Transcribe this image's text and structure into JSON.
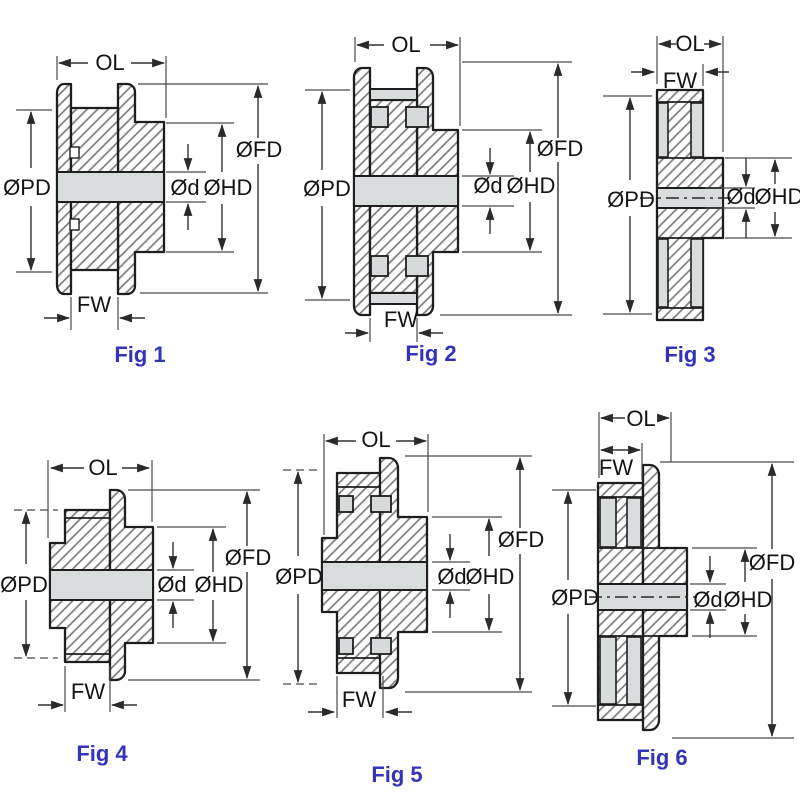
{
  "colors": {
    "caption_blue": "#3434bb",
    "outline": "#1e1e1e",
    "hatch_gray": "#7d7d7d",
    "light_fill": "#d9dcdc",
    "dimension_line": "#333333",
    "label_text": "#141414",
    "background": "#ffffff"
  },
  "figures": [
    {
      "caption": "Fig 1",
      "labels": {
        "ol": "OL",
        "fw": "FW",
        "pd": "ØPD",
        "fd": "ØFD",
        "hd": "ØHD",
        "d": "Ød"
      }
    },
    {
      "caption": "Fig 2",
      "labels": {
        "ol": "OL",
        "fw": "FW",
        "pd": "ØPD",
        "fd": "ØFD",
        "hd": "ØHD",
        "d": "Ød"
      }
    },
    {
      "caption": "Fig 3",
      "labels": {
        "ol": "OL",
        "fw": "FW",
        "pd": "ØPD",
        "hd": "ØHD",
        "d": "Ød"
      }
    },
    {
      "caption": "Fig 4",
      "labels": {
        "ol": "OL",
        "fw": "FW",
        "pd": "ØPD",
        "fd": "ØFD",
        "hd": "ØHD",
        "d": "Ød"
      }
    },
    {
      "caption": "Fig 5",
      "labels": {
        "ol": "OL",
        "fw": "FW",
        "pd": "ØPD",
        "fd": "ØFD",
        "hd": "ØHD",
        "d": "Ød"
      }
    },
    {
      "caption": "Fig 6",
      "labels": {
        "ol": "OL",
        "fw": "FW",
        "pd": "ØPD",
        "fd": "ØFD",
        "hd": "ØHD",
        "d": "Ød"
      }
    }
  ]
}
